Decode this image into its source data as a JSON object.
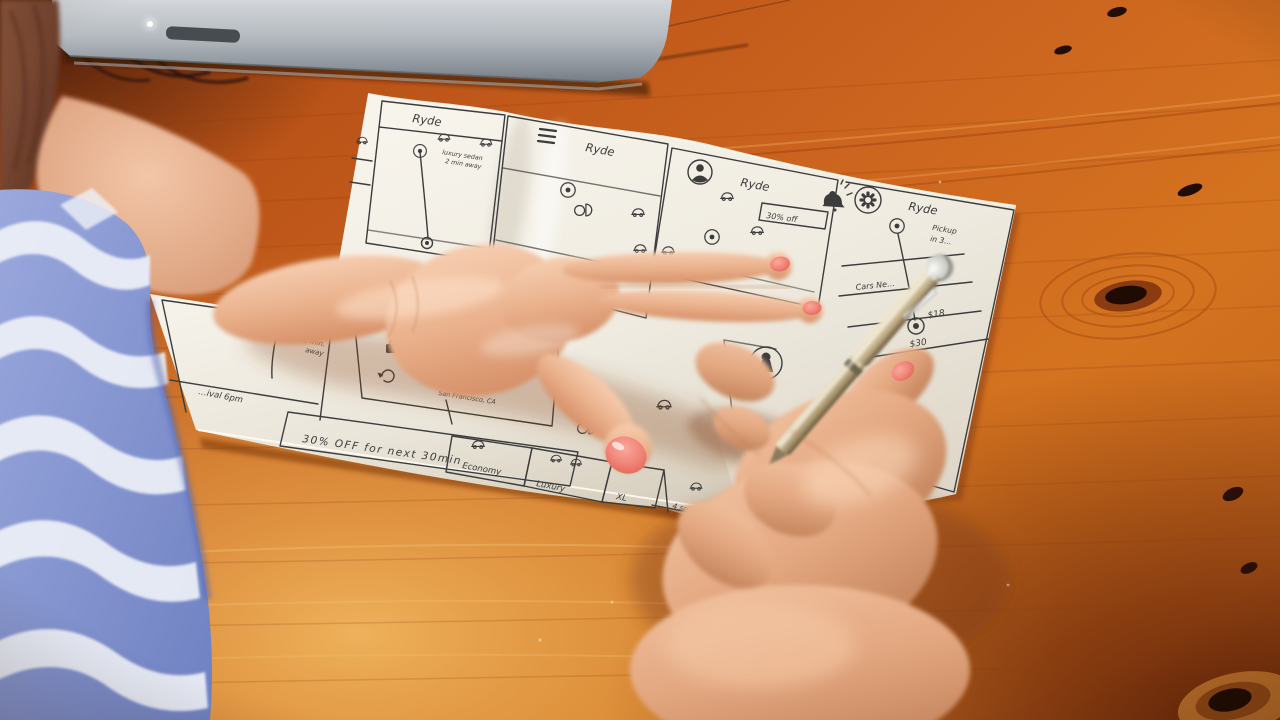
{
  "scene": {
    "subject": "hand-sketched mobile app wireframes on paper, wooden desk, laptop edge, hands with pen"
  },
  "colors": {
    "wood": "#c05a1c",
    "wood_light": "#eba94f",
    "wood_dark": "#6e2708",
    "paper": "#f1ede2",
    "ink": "#3c3c3c",
    "laptop_silver": "#a7adb3",
    "skin": "#eab695",
    "nail_polish": "#ef7c6e",
    "sleeve_blue": "#8494cf",
    "sleeve_white": "#eef1f7",
    "pen_champagne": "#c3b28b",
    "pen_silver": "#d9d9d4",
    "hair": "#7a4530"
  },
  "icons": [
    "hamburger-menu-icon",
    "profile-icon",
    "gear-icon",
    "bell-icon",
    "map-pin-icon",
    "car-icon",
    "close-icon",
    "home-icon",
    "briefcase-icon",
    "history-icon",
    "keyhole-icon"
  ],
  "wireframes": {
    "screen1": {
      "title": "Ryde",
      "pin_note_line1": "luxury sedan",
      "pin_note_line2": "2 min away"
    },
    "screen2": {
      "title": "Ryde"
    },
    "screen3": {
      "title": "Ryde",
      "promo_tag": "30% off"
    },
    "screen4": {
      "title": "Ryde",
      "pickup_line1": "Pickup",
      "pickup_line2": "in 3…",
      "list_row1": "Cars Ne…",
      "price_row1": "$18",
      "price_row2": "$30"
    },
    "map_detail": {
      "note_line1": "luxury",
      "note_line2": "sedan",
      "note_line3": "2 min.",
      "note_line4": "away",
      "footer": "…ival 6pm"
    },
    "location_list": {
      "item1": "Enter lo…",
      "item2": "Home",
      "item3": "Work",
      "item4": "Safeway",
      "item4_sub": "San Francisco, CA"
    },
    "promo_banner": {
      "text": "30% OFF for next 30min"
    },
    "ride_options": {
      "option1": "Economy",
      "option2": "Luxury",
      "option3": "XL",
      "option4_capacity": "4 seat"
    }
  }
}
